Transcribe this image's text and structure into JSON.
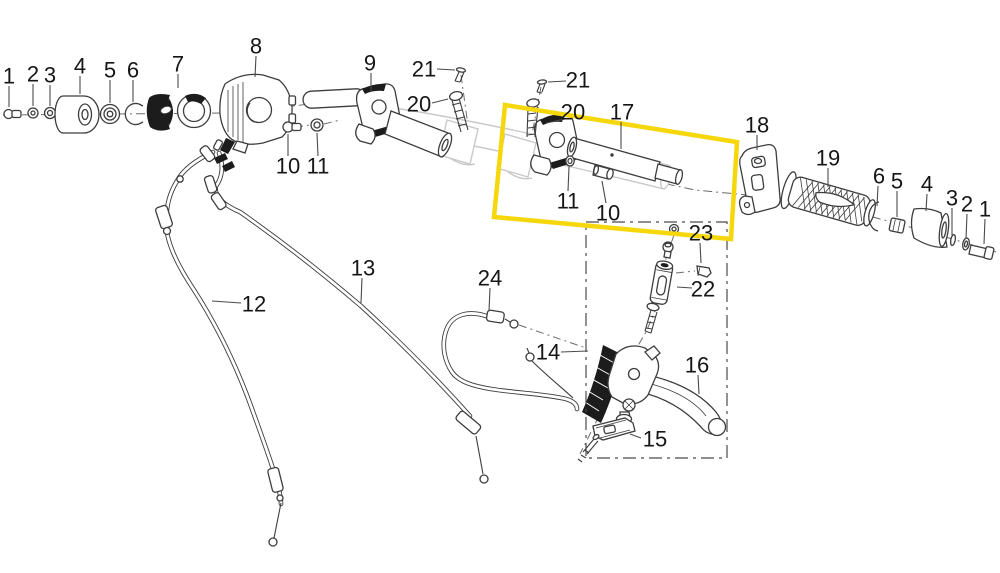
{
  "canvas": {
    "width": 1000,
    "height": 573,
    "background": "#ffffff"
  },
  "colors": {
    "line": "#3d3d3d",
    "dark_fill": "#1c1c1c",
    "ghost": "#c9c9c9",
    "leader": "#4a4a4a",
    "label_text": "#161616",
    "highlight": "#f5d70b",
    "detail_box": "#4a4a4a"
  },
  "highlight_box": {
    "shape": "polygon",
    "points": "505,105 737,142 731,239 494,217",
    "stroke_width": 4.5
  },
  "detail_box": {
    "shape": "dashed-rect",
    "x": 586,
    "y": 222,
    "width": 141,
    "height": 236
  },
  "part_labels": [
    {
      "num": "1",
      "x": 9,
      "y": 76,
      "leader": [
        9,
        86,
        9,
        107
      ]
    },
    {
      "num": "2",
      "x": 33,
      "y": 74,
      "leader": [
        33,
        84,
        33,
        106
      ]
    },
    {
      "num": "3",
      "x": 50,
      "y": 75,
      "leader": [
        50,
        85,
        50,
        106
      ]
    },
    {
      "num": "4",
      "x": 80,
      "y": 66,
      "leader": [
        80,
        76,
        80,
        94
      ]
    },
    {
      "num": "5",
      "x": 110,
      "y": 70,
      "leader": [
        110,
        80,
        110,
        103
      ]
    },
    {
      "num": "6",
      "x": 133,
      "y": 70,
      "leader": [
        133,
        80,
        133,
        102
      ]
    },
    {
      "num": "7",
      "x": 178,
      "y": 64,
      "leader": [
        178,
        74,
        178,
        88
      ]
    },
    {
      "num": "8",
      "x": 256,
      "y": 46,
      "leader": [
        256,
        56,
        255,
        77
      ]
    },
    {
      "num": "9",
      "x": 370,
      "y": 63,
      "leader": [
        371,
        73,
        371,
        92
      ]
    },
    {
      "num": "10",
      "x": 288,
      "y": 166,
      "leader": [
        288,
        156,
        288,
        134
      ]
    },
    {
      "num": "11",
      "x": 318,
      "y": 166,
      "leader": [
        318,
        156,
        317,
        133
      ]
    },
    {
      "num": "21",
      "x": 424,
      "y": 69,
      "leader": [
        437,
        69,
        455,
        70
      ]
    },
    {
      "num": "20",
      "x": 419,
      "y": 104,
      "leader": [
        432,
        103,
        448,
        99
      ]
    },
    {
      "num": "21",
      "x": 578,
      "y": 80,
      "leader": [
        566,
        81,
        548,
        82
      ]
    },
    {
      "num": "20",
      "x": 573,
      "y": 112,
      "leader": [
        565,
        119,
        546,
        123
      ]
    },
    {
      "num": "17",
      "x": 622,
      "y": 112,
      "leader": [
        621,
        122,
        621,
        149
      ]
    },
    {
      "num": "11",
      "x": 568,
      "y": 201,
      "leader": [
        568,
        191,
        569,
        167
      ]
    },
    {
      "num": "10",
      "x": 608,
      "y": 213,
      "leader": [
        606,
        203,
        602,
        181
      ]
    },
    {
      "num": "18",
      "x": 757,
      "y": 125,
      "leader": [
        757,
        135,
        757,
        150
      ]
    },
    {
      "num": "19",
      "x": 828,
      "y": 158,
      "leader": [
        828,
        168,
        828,
        187
      ]
    },
    {
      "num": "6",
      "x": 879,
      "y": 176,
      "leader": [
        878,
        186,
        877,
        206
      ]
    },
    {
      "num": "5",
      "x": 897,
      "y": 181,
      "leader": [
        897,
        191,
        897,
        217
      ]
    },
    {
      "num": "4",
      "x": 927,
      "y": 184,
      "leader": [
        927,
        194,
        926,
        211
      ]
    },
    {
      "num": "3",
      "x": 952,
      "y": 198,
      "leader": [
        952,
        208,
        952,
        235
      ]
    },
    {
      "num": "2",
      "x": 967,
      "y": 204,
      "leader": [
        967,
        214,
        966,
        239
      ]
    },
    {
      "num": "1",
      "x": 985,
      "y": 209,
      "leader": [
        985,
        219,
        984,
        244
      ]
    },
    {
      "num": "12",
      "x": 254,
      "y": 304,
      "leader": [
        241,
        303,
        212,
        301
      ]
    },
    {
      "num": "13",
      "x": 363,
      "y": 268,
      "leader": [
        362,
        278,
        361,
        303
      ]
    },
    {
      "num": "24",
      "x": 490,
      "y": 278,
      "leader": [
        490,
        288,
        489,
        311
      ]
    },
    {
      "num": "14",
      "x": 548,
      "y": 352,
      "leader": [
        561,
        352,
        588,
        351
      ]
    },
    {
      "num": "23",
      "x": 701,
      "y": 233,
      "leader": [
        700,
        243,
        701,
        263
      ]
    },
    {
      "num": "22",
      "x": 703,
      "y": 289,
      "leader": [
        692,
        288,
        677,
        287
      ]
    },
    {
      "num": "16",
      "x": 697,
      "y": 365,
      "leader": [
        698,
        375,
        699,
        394
      ]
    },
    {
      "num": "15",
      "x": 655,
      "y": 439,
      "leader": [
        641,
        438,
        630,
        434
      ]
    }
  ]
}
